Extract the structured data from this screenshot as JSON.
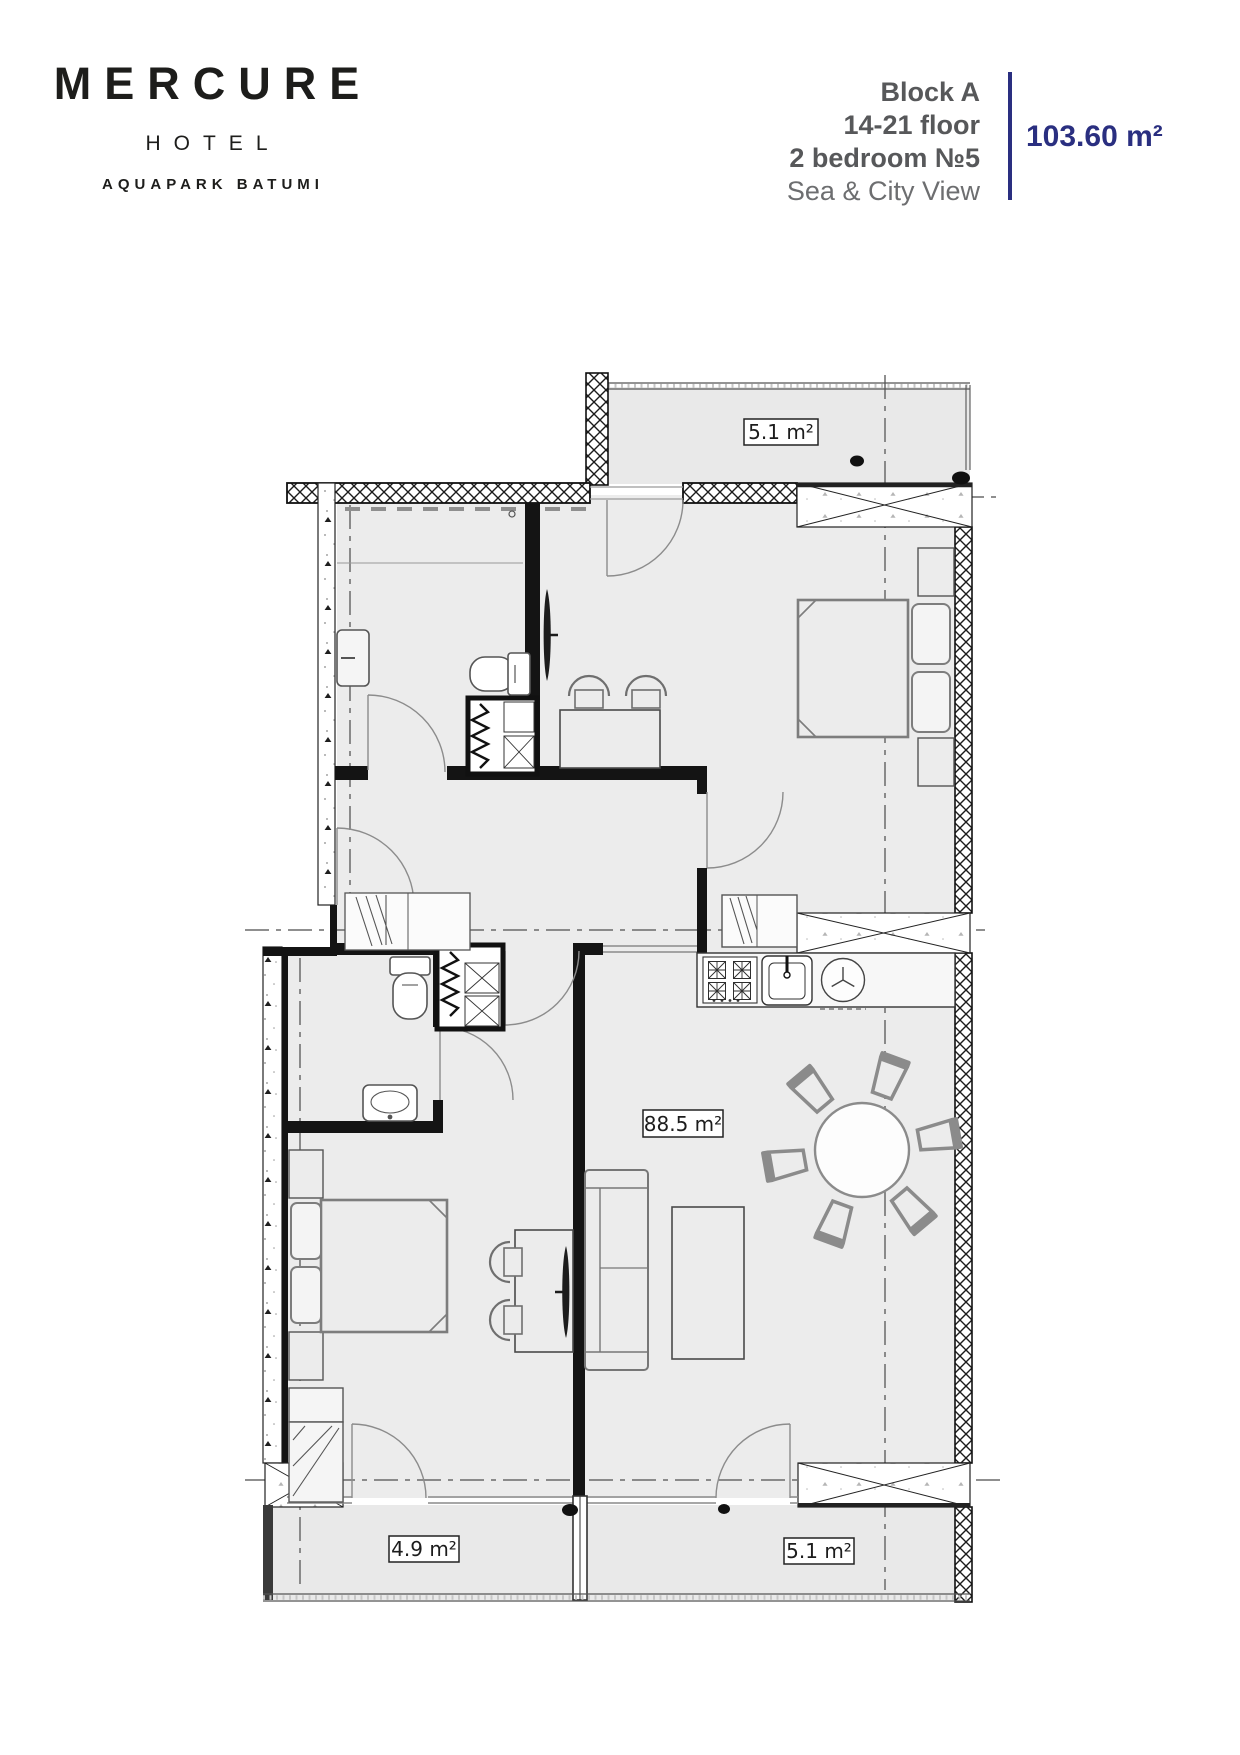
{
  "header": {
    "logo": {
      "brand": "MERCURE",
      "tier": "HOTEL",
      "location": "AQUAPARK BATUMI"
    },
    "unit": {
      "block": "Block A",
      "floors": "14-21 floor",
      "type": "2 bedroom №5",
      "view": "Sea & City View"
    },
    "area_total": "103.60 m²",
    "colors": {
      "accent": "#2a2f80",
      "text_gray": "#57585a",
      "logo_black": "#1d1d1b"
    }
  },
  "plan": {
    "labels": {
      "balcony_top": "5.1 m²",
      "living": "88.5 m²",
      "balcony_bottom_left": "4.9 m²",
      "balcony_bottom_right": "5.1 m²"
    },
    "colors": {
      "floor_fill": "#ececec",
      "wall": "#141414"
    }
  }
}
